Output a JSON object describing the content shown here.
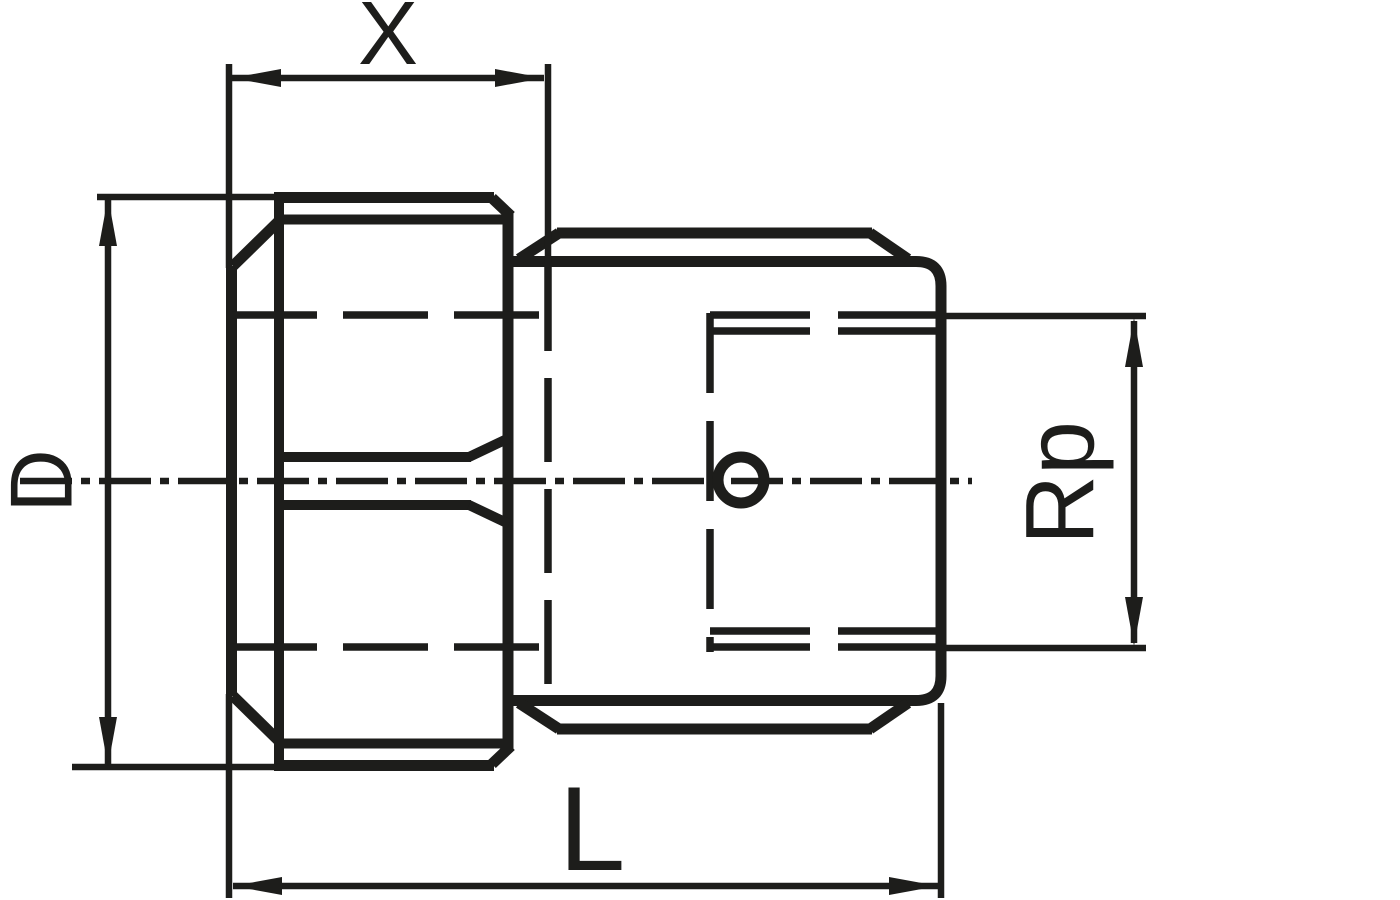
{
  "drawing": {
    "background_color": "#ffffff",
    "line_color": "#1d1d1b",
    "dimensions": {
      "hex_width": {
        "label": "X"
      },
      "outer_diameter": {
        "label": "D"
      },
      "overall_length": {
        "label": "L"
      },
      "thread": {
        "label": "Rp"
      }
    }
  }
}
